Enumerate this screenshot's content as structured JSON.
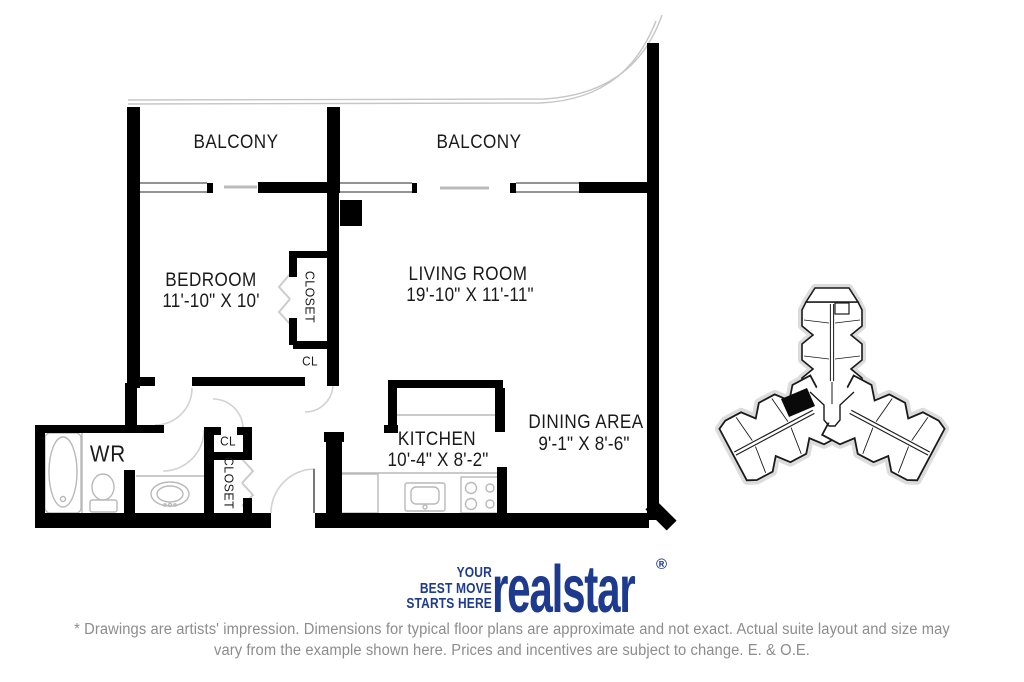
{
  "plan": {
    "balcony_left": "BALCONY",
    "balcony_right": "BALCONY",
    "rooms": {
      "bedroom": {
        "label": "BEDROOM",
        "dims": "11'-10\" X 10'"
      },
      "living_room": {
        "label": "LIVING ROOM",
        "dims": "19'-10\" X 11'-11\""
      },
      "kitchen": {
        "label": "KITCHEN",
        "dims": "10'-4\" X 8'-2\""
      },
      "dining_area": {
        "label": "DINING AREA",
        "dims": "9'-1\" X 8'-6\""
      },
      "washroom": {
        "label": "WR"
      },
      "bedroom_closet": {
        "label": "CLOSET"
      },
      "hall_closet": {
        "label": "CL"
      },
      "entry_closet_upper": {
        "label": "CL"
      },
      "entry_closet": {
        "label": "CLOSET"
      }
    },
    "wall_color": "#000000",
    "fixture_line_color": "#b9b9b9"
  },
  "key_plan": {
    "icon": "building-footprint-key-plan",
    "unit_marker_color": "#000000"
  },
  "logo": {
    "tagline": {
      "line1": "YOUR",
      "line2": "BEST MOVE",
      "line3": "STARTS HERE"
    },
    "brand": "realstar",
    "registered_mark": "®",
    "brand_color": "#1e3a8e"
  },
  "disclaimer": {
    "line1": "* Drawings are artists' impression. Dimensions for typical floor plans are approximate and not exact. Actual suite layout and size may",
    "line2": "vary from the example shown here. Prices and incentives are subject to change. E. & O.E.",
    "text_color": "#8c8c8c"
  }
}
